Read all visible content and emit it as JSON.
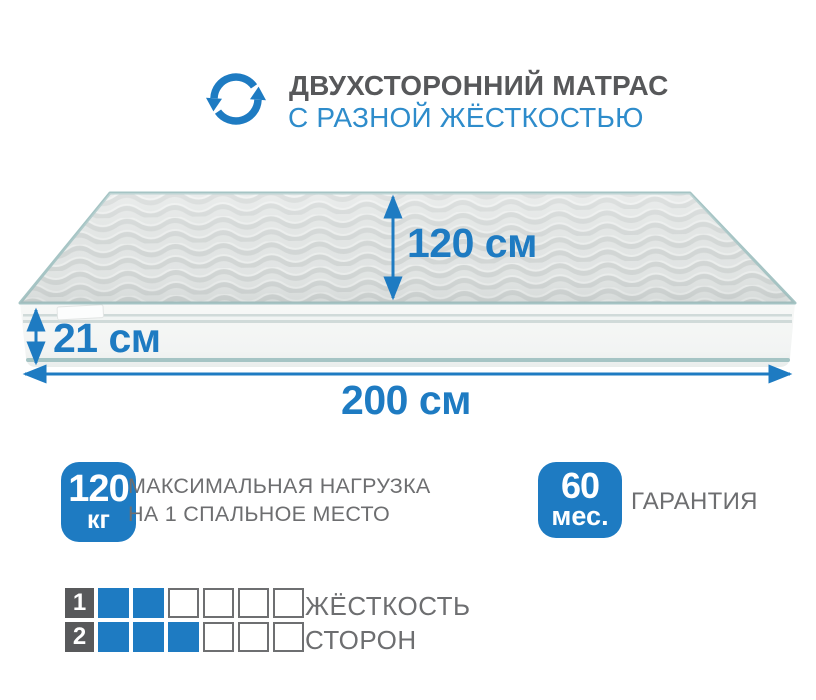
{
  "header": {
    "title": "ДВУХСТОРОННИЙ МАТРАС",
    "subtitle": "С РАЗНОЙ ЖЁСТКОСТЬЮ"
  },
  "icons": {
    "rotate": "rotate-icon"
  },
  "mattress": {
    "depth_label": "120 см",
    "height_label": "21 см",
    "width_label": "200 см"
  },
  "load_badge": {
    "value": "120",
    "unit": "кг",
    "line1": "МАКСИМАЛЬНАЯ НАГРУЗКА",
    "line2": "НА 1 СПАЛЬНОЕ МЕСТО"
  },
  "warranty_badge": {
    "value": "60",
    "unit": "мес.",
    "label": "ГАРАНТИЯ"
  },
  "firmness": {
    "line1": "ЖЁСТКОСТЬ",
    "line2": "СТОРОН",
    "rows": [
      {
        "side": "1",
        "filled": 2,
        "total": 6
      },
      {
        "side": "2",
        "filled": 3,
        "total": 6
      }
    ]
  },
  "colors": {
    "accent_blue": "#1e7bc2",
    "subtitle_blue": "#2e8ccb",
    "title_gray": "#57585a",
    "text_gray": "#6d6e70",
    "label_square_gray": "#58595b",
    "square_border_gray": "#6e6f71",
    "piping_teal": "#a5c4c4",
    "mattress_top_gray": "#e3e6e5",
    "mattress_face_white": "#f5f6f5"
  }
}
